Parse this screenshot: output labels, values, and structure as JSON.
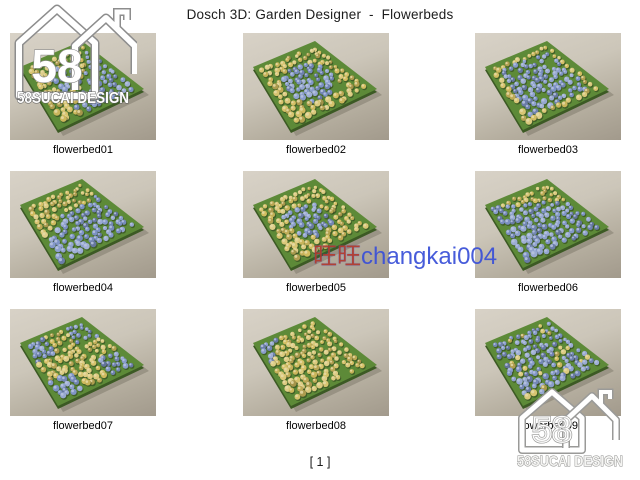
{
  "title": "Dosch 3D: Garden Designer  -  Flowerbeds",
  "page_label": "[ 1 ]",
  "watermark": {
    "cn": "旺旺",
    "id": "changkai004"
  },
  "logo": {
    "number": "58",
    "caption": "58SUCAI DESIGN"
  },
  "beds": [
    {
      "id": "flowerbed01",
      "label": "flowerbed01",
      "pattern": "mixed"
    },
    {
      "id": "flowerbed02",
      "label": "flowerbed02",
      "pattern": "circle"
    },
    {
      "id": "flowerbed03",
      "label": "flowerbed03",
      "pattern": "border"
    },
    {
      "id": "flowerbed04",
      "label": "flowerbed04",
      "pattern": "split"
    },
    {
      "id": "flowerbed05",
      "label": "flowerbed05",
      "pattern": "diamond"
    },
    {
      "id": "flowerbed06",
      "label": "flowerbed06",
      "pattern": "topband"
    },
    {
      "id": "flowerbed07",
      "label": "flowerbed07",
      "pattern": "xband"
    },
    {
      "id": "flowerbed08",
      "label": "flowerbed08",
      "pattern": "leftband"
    },
    {
      "id": "flowerbed09",
      "label": "flowerbed09",
      "pattern": "scatter"
    }
  ],
  "colors": {
    "platform_green": "#5d8a38",
    "flower_yellow": "#d2bd5f",
    "flower_blue": "#7e93c6",
    "thumb_bg_top": "#d8d2c7",
    "thumb_bg_bottom": "#a29a8c",
    "watermark_red": "#b23b2e",
    "watermark_blue": "#3a50d8",
    "logo_white": "#ffffff"
  }
}
